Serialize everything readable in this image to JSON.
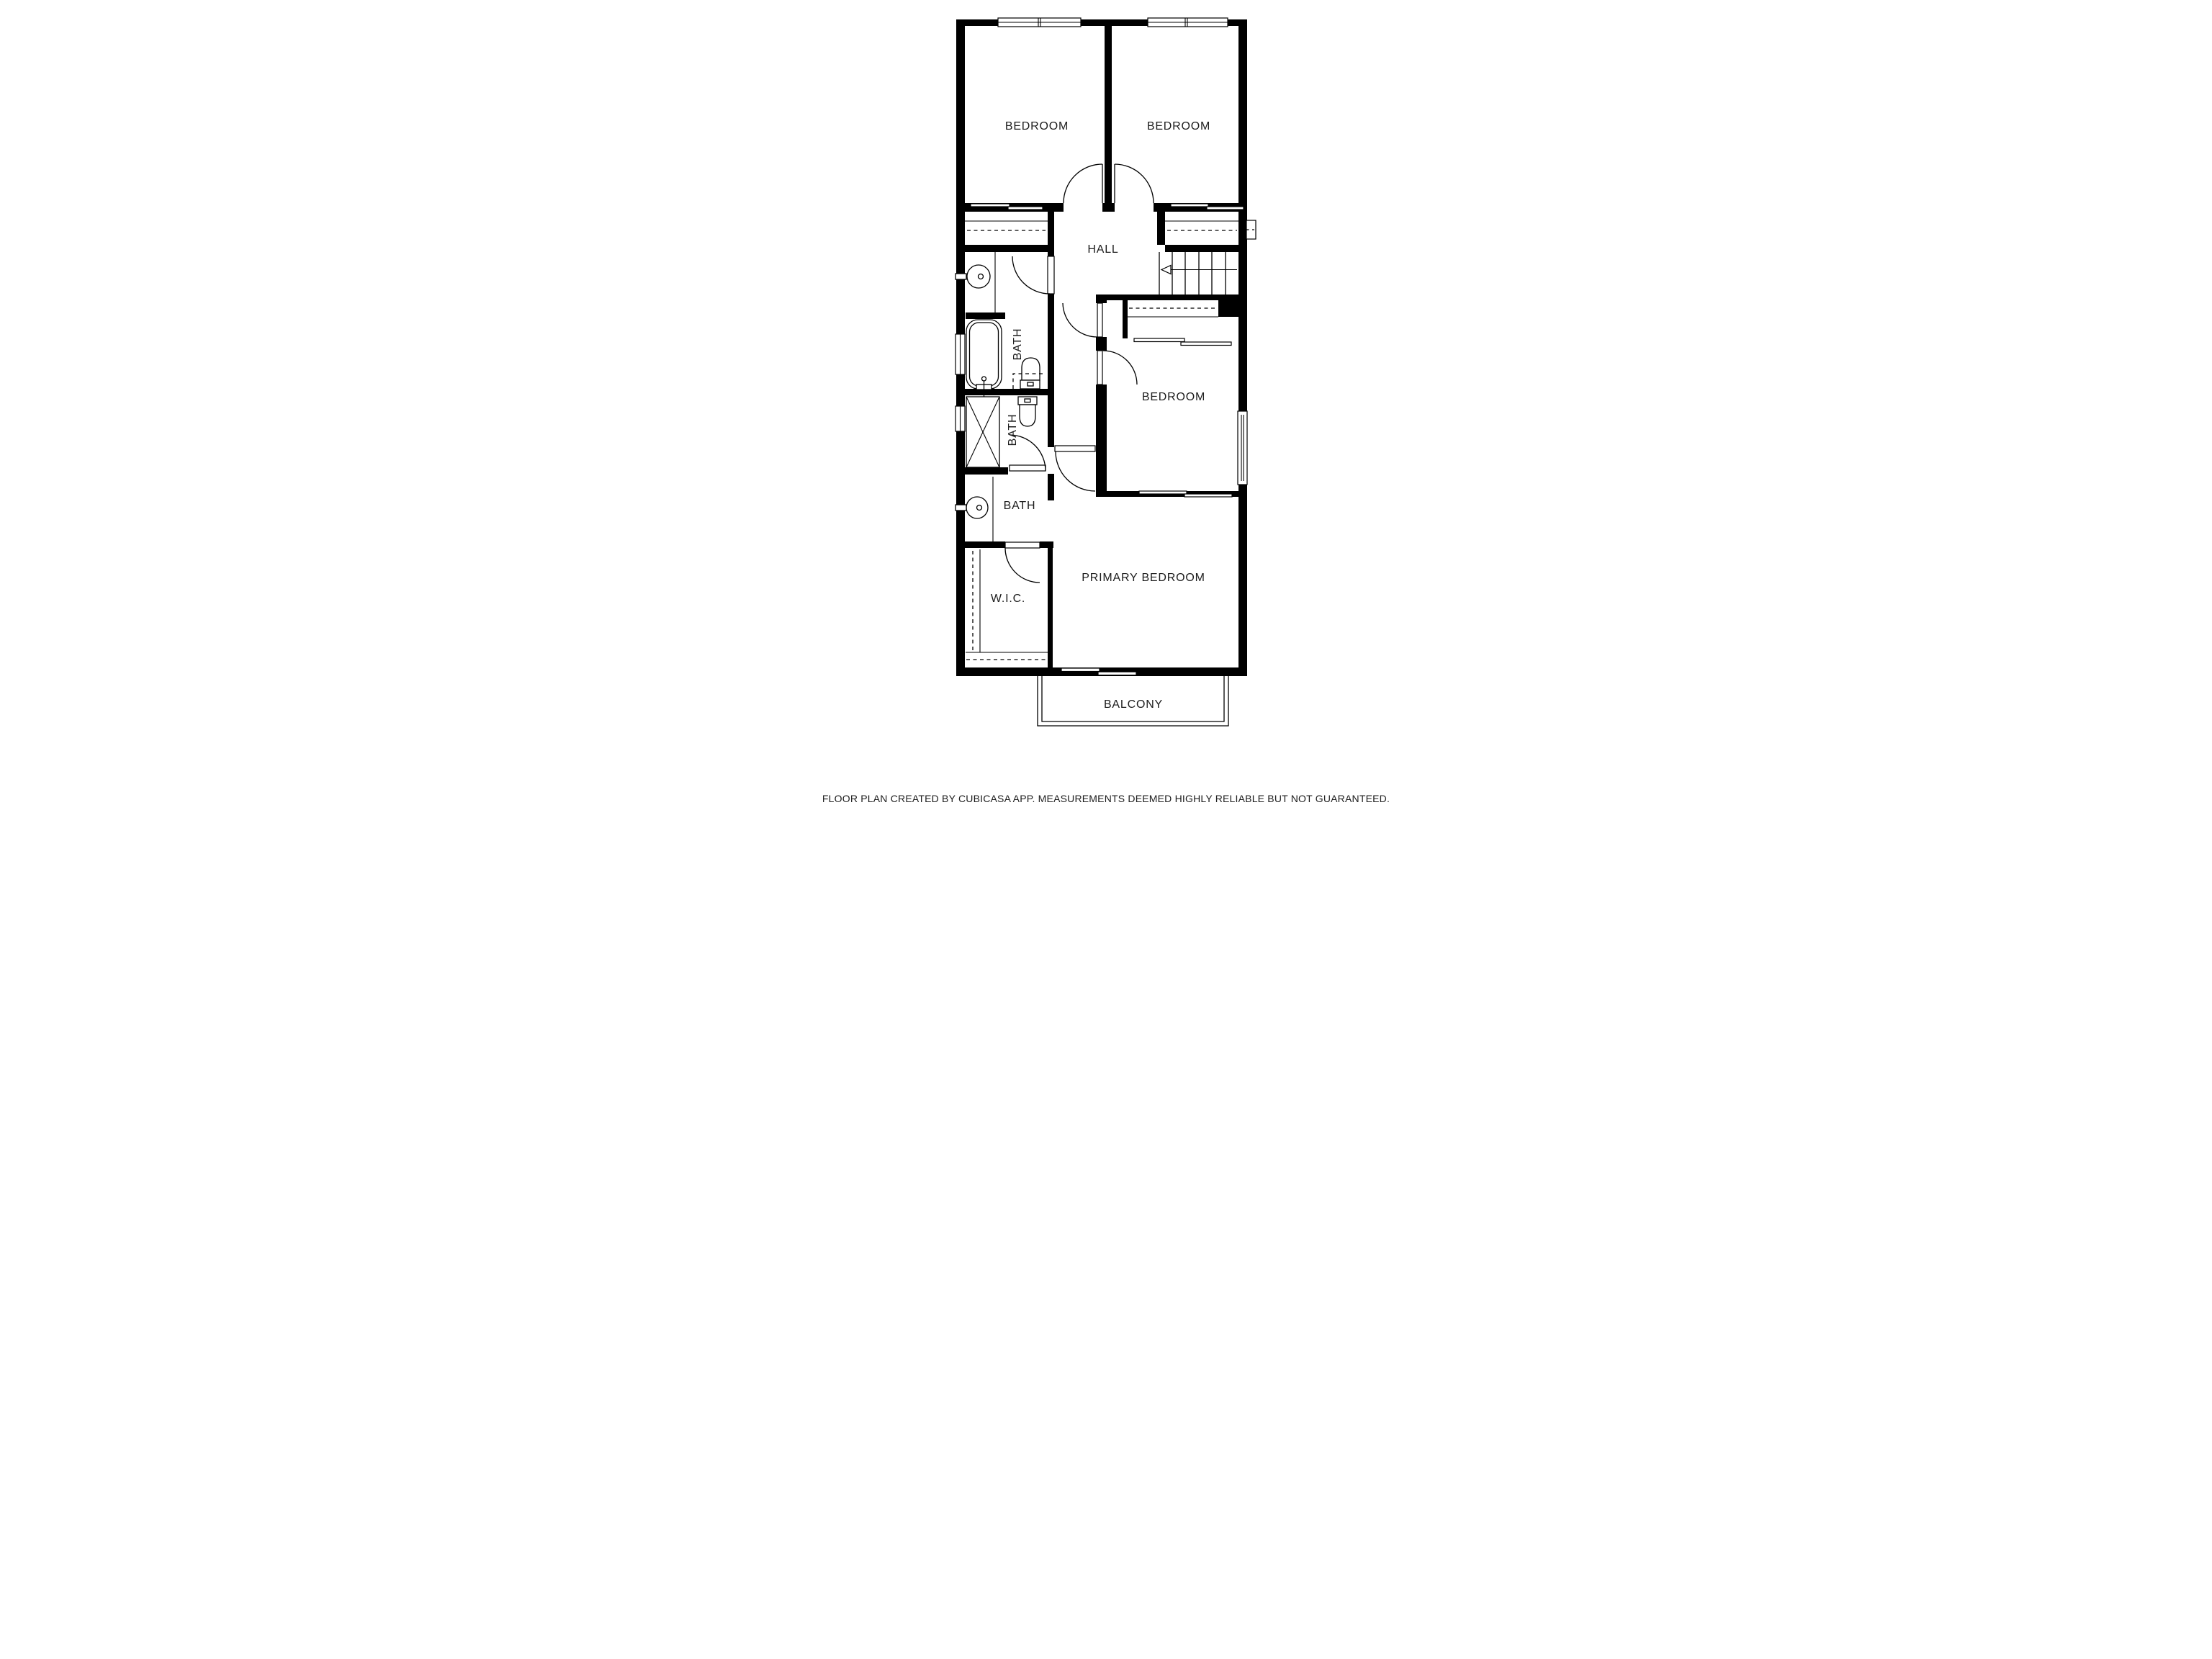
{
  "canvas": {
    "background_color": "#ffffff",
    "wall_color": "#000000",
    "text_color": "#1c1c1c"
  },
  "rooms": {
    "bedroom_top_left": {
      "label": "BEDROOM"
    },
    "bedroom_top_right": {
      "label": "BEDROOM"
    },
    "hall": {
      "label": "HALL"
    },
    "bath_upper": {
      "label": "BATH"
    },
    "bath_middle": {
      "label": "BATH"
    },
    "bath_lower": {
      "label": "BATH"
    },
    "bedroom_middle": {
      "label": "BEDROOM"
    },
    "primary_bedroom": {
      "label": "PRIMARY BEDROOM"
    },
    "walk_in_closet": {
      "label": "W.I.C."
    },
    "balcony": {
      "label": "BALCONY"
    }
  },
  "footer": {
    "disclaimer": "FLOOR PLAN CREATED BY CUBICASA APP. MEASUREMENTS DEEMED HIGHLY RELIABLE BUT NOT GUARANTEED."
  }
}
